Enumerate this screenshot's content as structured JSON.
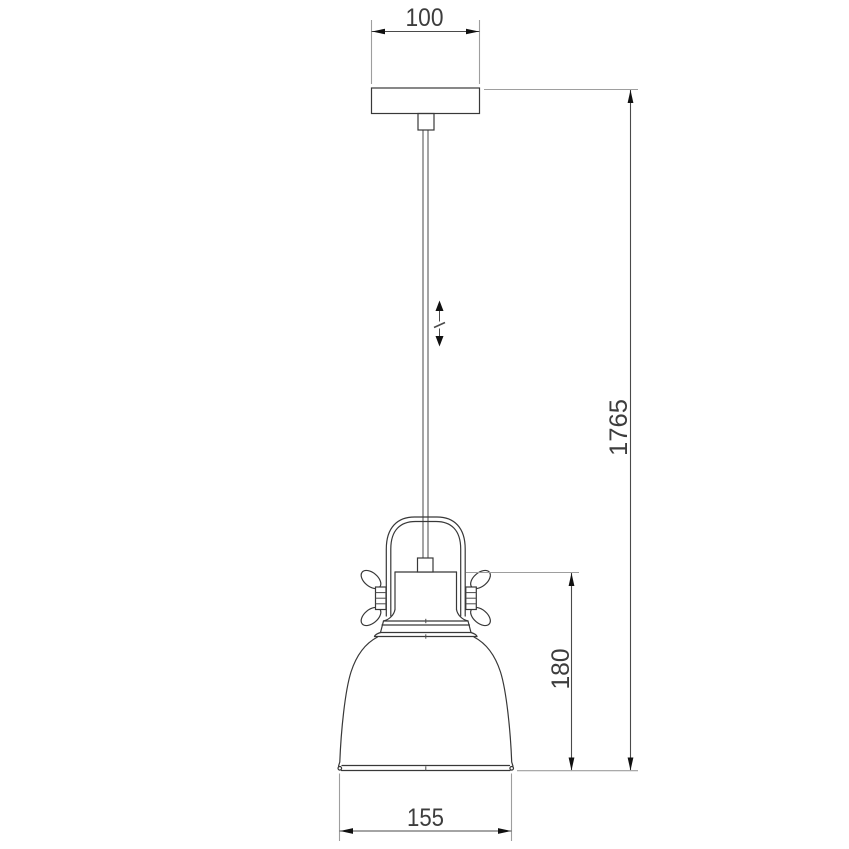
{
  "colors": {
    "background": "#ffffff",
    "object_line": "#383838",
    "extension_line": "#9e9e9e",
    "dimension_line": "#4a4a4a",
    "arrowhead": "#111111",
    "text": "#3d3d3d"
  },
  "drawing": {
    "kind": "technical dimension line drawing",
    "subject": "pendant ceiling lamp, front elevation",
    "dimensions": {
      "canopy_width": {
        "label": "100",
        "orientation": "horizontal",
        "position": "top"
      },
      "overall_height": {
        "label": "1765",
        "orientation": "vertical",
        "position": "right"
      },
      "shade_height": {
        "label": "180",
        "orientation": "vertical",
        "position": "right-inner"
      },
      "shade_diameter": {
        "label": "155",
        "orientation": "horizontal",
        "position": "bottom"
      }
    },
    "symbols": {
      "height_adjustable_icon": "vertical double-headed arrow with break mark beside suspension cord"
    },
    "parts": [
      "ceiling-canopy",
      "cord-connector",
      "suspension-cord",
      "yoke-handle",
      "cord-ferrule",
      "lamp-holder",
      "wing-nut-left",
      "wing-nut-right",
      "bell-shade"
    ]
  }
}
